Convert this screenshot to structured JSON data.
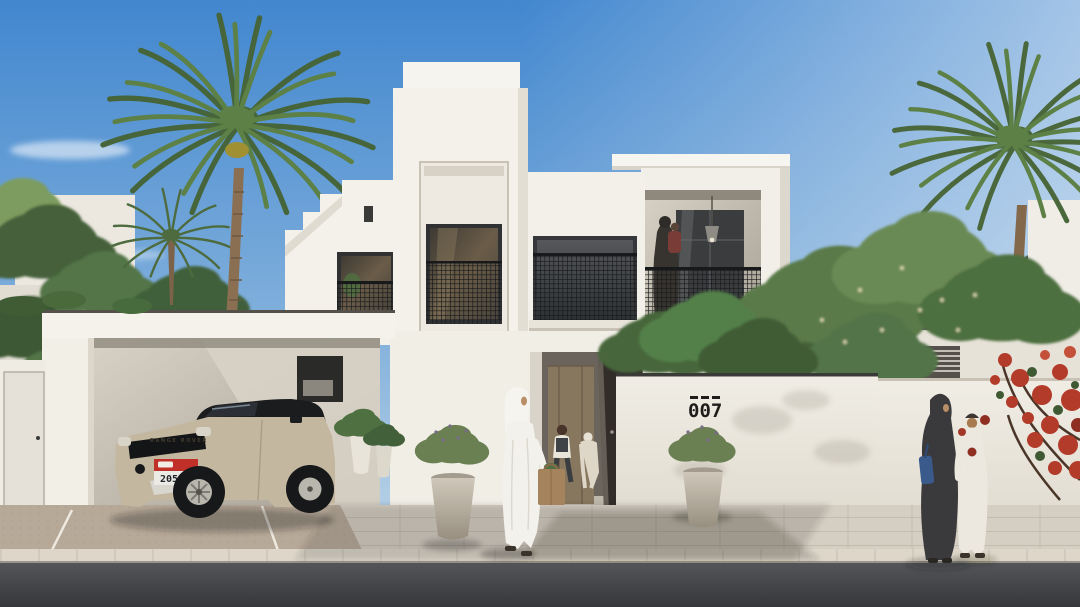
{
  "meta": {
    "description": "Photorealistic architectural rendering of a modern two-storey white villa with date palms, a carport with an SUV, and pedestrians in traditional Emirati dress on a sunny street"
  },
  "house": {
    "number_sign": {
      "dashes": "- - -",
      "number": "007"
    }
  },
  "car": {
    "hood_text": "RANGE ROVER",
    "license_plate": {
      "band_color": "#c03028",
      "number": "20534"
    }
  },
  "palette": {
    "sky_top": "#4287cf",
    "sky_horizon": "#cfe0ec",
    "villa_white": "#f4f1ea",
    "window_frame": "#2f3133",
    "railing_mesh": "#17191b",
    "foliage": "#527547",
    "palm_trunk": "#8a6f52",
    "bougainvillea": "#b23b2a",
    "sidewalk": "#d5cec2",
    "driveway": "#b7a998",
    "road": "#3b3d40",
    "car_body": "#c4b7a0"
  },
  "objects": [
    "blue-sky",
    "date-palm-left",
    "date-palm-right",
    "background-villas",
    "white-villa-stepped-parapet",
    "tower-window-juliet-balcony",
    "center-juliet-balcony",
    "right-wing-balcony-with-woman-and-child",
    "pendant-light",
    "entrance-with-wooden-door-and-open-gate",
    "two-children-at-entrance",
    "carport",
    "range-rover-evoque",
    "boundary-wall-house-number-007",
    "stone-planters-with-lavender",
    "man-in-white-kandura-with-grocery-bag",
    "woman-in-dark-abaya",
    "boy-in-white-kandura",
    "red-bougainvillea",
    "paved-sidewalk",
    "asphalt-road"
  ]
}
